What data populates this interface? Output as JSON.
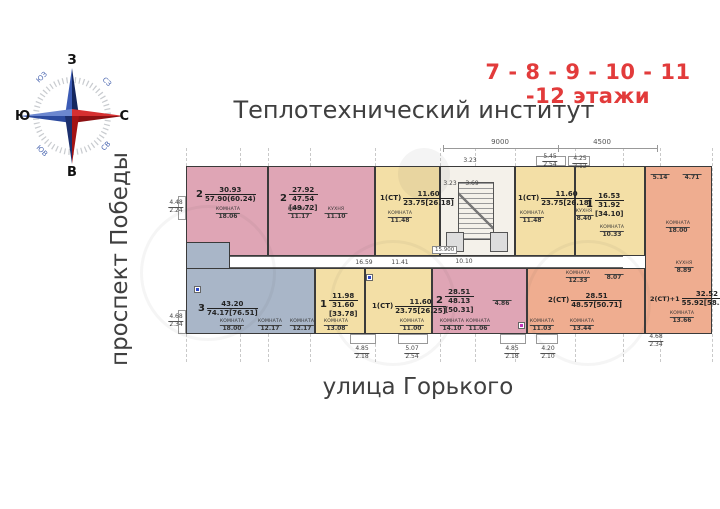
{
  "header": {
    "floors": "7 - 8 - 9 - 10 - 11 -12 этажи",
    "title": "Теплотехнический институт"
  },
  "streets": {
    "left": "проспект Победы",
    "bottom": "улица Горького"
  },
  "compass": {
    "n": "С",
    "s": "Ю",
    "w": "З",
    "e": "В",
    "nw": "СЗ",
    "ne": "СВ",
    "sw": "ЮЗ",
    "se": "ЮВ"
  },
  "colors": {
    "accent-red": "#e23b3b",
    "pink": "#dfa5b5",
    "blue": "#a9b6c8",
    "yellow": "#f3dfa6",
    "orange": "#efad90",
    "wall": "#3a3a3a",
    "text": "#3f3f3f"
  },
  "apartments": {
    "t1": {
      "num": "2",
      "a": "30.93",
      "b": "57.90(60.24)"
    },
    "t2": {
      "num": "2",
      "a": "27.92",
      "b": "47.54",
      "c": "[49.72]"
    },
    "t3": {
      "num": "1(СТ)",
      "a": "11.60",
      "b": "23.75[26.18]"
    },
    "t4": {
      "num": "1(СТ)",
      "a": "11.60",
      "b": "23.75[26.18]"
    },
    "t5": {
      "num": "1",
      "a": "16.53",
      "b": "31.92",
      "c": "[34.10]"
    },
    "b1": {
      "num": "3",
      "a": "43.20",
      "b": "74.17[76.51]"
    },
    "b2": {
      "num": "1",
      "a": "11.98",
      "b": "31.60",
      "c": "[33.78]"
    },
    "b3": {
      "num": "1(СТ)",
      "a": "11.60",
      "b": "23.75[26.25]"
    },
    "b4": {
      "num": "2",
      "a": "28.51",
      "b": "48.13",
      "c": "[50.31]"
    },
    "b5": {
      "num": "2(СТ)",
      "a": "28.51",
      "b": "48.57[50.71]"
    },
    "r1": {
      "num": "2(СТ)+1",
      "a": "32.52",
      "b": "55.92[58.26]"
    }
  },
  "rooms": {
    "t1r1": {
      "cap": "КОМНАТА",
      "v": "18.06"
    },
    "t2r1": {
      "cap": "КОМНАТА",
      "v": "11.17"
    },
    "t2r2": {
      "cap": "КУХНЯ",
      "v": "11.10"
    },
    "t3r1": {
      "cap": "КОМНАТА",
      "v": "11.48"
    },
    "t4r1": {
      "cap": "КОМНАТА",
      "v": "11.48"
    },
    "t5r1": {
      "cap": "КУХНЯ",
      "v": "8.40"
    },
    "t5r2": {
      "cap": "КОМНАТА",
      "v": "10.33"
    },
    "b1r1": {
      "cap": "КОМНАТА",
      "v": "18.00"
    },
    "b1r2": {
      "cap": "КОМНАТА",
      "v": "12.17"
    },
    "b1r3": {
      "cap": "КОМНАТА",
      "v": "12.17"
    },
    "b2r1": {
      "cap": "КОМНАТА",
      "v": "13.08"
    },
    "b3r1": {
      "cap": "КОМНАТА",
      "v": "11.00"
    },
    "b4r1": {
      "cap": "КОМНАТА",
      "v": "14.10"
    },
    "b4r2": {
      "cap": "КОМНАТА",
      "v": "11.06"
    },
    "b4r3": {
      "cap": "",
      "v": "4.86"
    },
    "b5r1": {
      "cap": "КОМНАТА",
      "v": "11.03"
    },
    "b5r2": {
      "cap": "КОМНАТА",
      "v": "13.44"
    },
    "b5r3": {
      "cap": "КОМНАТА",
      "v": "12.33"
    },
    "b5r4": {
      "cap": "",
      "v": "8.07"
    },
    "r1r1": {
      "cap": "КОМНАТА",
      "v": "18.00"
    },
    "r1r2": {
      "cap": "",
      "v": "5.14"
    },
    "r1r3": {
      "cap": "",
      "v": "4.71"
    },
    "r1r4": {
      "cap": "КУХНЯ",
      "v": "8.89"
    },
    "r1r5": {
      "cap": "КОМНАТА",
      "v": "13.66"
    }
  },
  "dims": {
    "top1": "9000",
    "top2": "4500",
    "f1": {
      "a": "4.48",
      "b": "2.24"
    },
    "f2": {
      "a": "4.68",
      "b": "2.34"
    },
    "f3": {
      "a": "5.45",
      "b": "2.54"
    },
    "f4": {
      "a": "4.25",
      "b": "2.12"
    },
    "f5": {
      "a": "4.85",
      "b": "2.18"
    },
    "f6": {
      "a": "5.07",
      "b": "2.54"
    },
    "f7": {
      "a": "4.85",
      "b": "2.18"
    },
    "f8": {
      "a": "4.20",
      "b": "2.10"
    },
    "f9": {
      "a": "4.68",
      "b": "2.34"
    },
    "c1": "3.23",
    "c2": "3.69",
    "c3": "3.23",
    "k1": "16.59",
    "k2": "11.41",
    "k3": "10.10",
    "elev": "15.900"
  }
}
